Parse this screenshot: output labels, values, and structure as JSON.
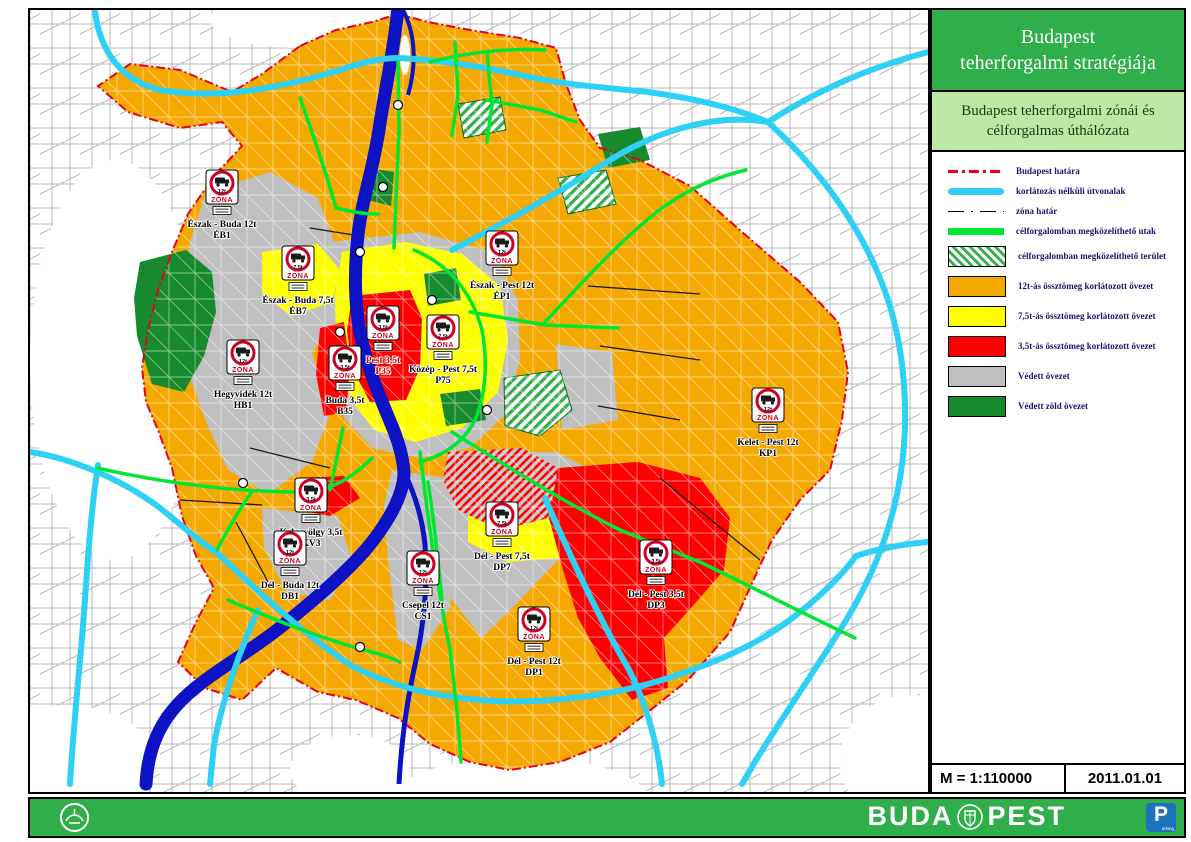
{
  "panel": {
    "title": "Budapest\nteherforgalmi stratégiája",
    "subtitle": "Budapest teherforgalmi zónái és\ncélforgalmas úthálózata",
    "legend": {
      "items": [
        {
          "label": "Budapest határa",
          "swatch": "sw-budapest-border"
        },
        {
          "label": "korlátozás nélküli útvonalak",
          "swatch": "sw-cyan"
        },
        {
          "label": "zóna határ",
          "swatch": "sw-zone-border"
        },
        {
          "label": "célforgalomban megközelíthető utak",
          "swatch": "sw-green-road"
        },
        {
          "label": "célforgalomban megközelíthető terület",
          "swatch": "sw-box-hatch"
        },
        {
          "label": "12t-ás össztömeg korlátozott övezet",
          "swatch": "sw-box-orange"
        },
        {
          "label": "7,5t-ás össztömeg korlátozott övezet",
          "swatch": "sw-box-yellow"
        },
        {
          "label": "3,5t-ás össztömeg korlátozott övezet",
          "swatch": "sw-box-red"
        },
        {
          "label": "Védett övezet",
          "swatch": "sw-box-gray"
        },
        {
          "label": "Védett zöld övezet",
          "swatch": "sw-box-green"
        }
      ]
    },
    "scale_label": "M = 1:110000",
    "date_label": "2011.01.01"
  },
  "footer": {
    "brand_left": "BUDA",
    "brand_right": "PEST",
    "parking_p": "P",
    "parking_sub": "arking"
  },
  "map": {
    "sign_zona": "ZÓNA",
    "colors": {
      "zone_12t": "#F5A800",
      "zone_7_5t": "#FFFF00",
      "zone_3_5t": "#FF0000",
      "protected_zone": "#BFBFBF",
      "protected_green_zone": "#168A2C",
      "accessible_roads": "#00E632",
      "unrestricted_roads": "#2FD0F5",
      "budapest_border": "#E8001C",
      "river": "#0D12C4",
      "header_green": "#2FAE49",
      "subheader_green": "#BCE8A6"
    },
    "zones": [
      {
        "name": "Észak - Buda 12t",
        "code": "ÉB1",
        "weight": "12t",
        "x": 222,
        "y": 192
      },
      {
        "name": "Észak - Buda 7,5t",
        "code": "ÉB7",
        "weight": "7,5t",
        "x": 298,
        "y": 268
      },
      {
        "name": "Hegyvidék 12t",
        "code": "HB1",
        "weight": "12t",
        "x": 243,
        "y": 362
      },
      {
        "name": "Észak - Pest 12t",
        "code": "ÉP1",
        "weight": "12t",
        "x": 502,
        "y": 253
      },
      {
        "name": "Közép - Pest 7,5t",
        "code": "P75",
        "weight": "7,5t",
        "x": 443,
        "y": 337
      },
      {
        "name": "Pest 3,5t",
        "code": "P35",
        "weight": "3,5t",
        "x": 383,
        "y": 328,
        "color": "#c00000"
      },
      {
        "name": "Buda 3,5t",
        "code": "B35",
        "weight": "3,5t",
        "x": 345,
        "y": 368
      },
      {
        "name": "Kelet - Pest 12t",
        "code": "KP1",
        "weight": "12t",
        "x": 768,
        "y": 410
      },
      {
        "name": "Kelenvölgy 3,5t",
        "code": "KV3",
        "weight": "3,5t",
        "x": 311,
        "y": 500
      },
      {
        "name": "Dél - Buda 12t",
        "code": "DB1",
        "weight": "12t",
        "x": 290,
        "y": 553
      },
      {
        "name": "Csepel 12t",
        "code": "CS1",
        "weight": "12t",
        "x": 423,
        "y": 573
      },
      {
        "name": "Dél - Pest 7,5t",
        "code": "DP7",
        "weight": "7,5t",
        "x": 502,
        "y": 524
      },
      {
        "name": "Dél - Pest 12t",
        "code": "DP1",
        "weight": "12t",
        "x": 534,
        "y": 629
      },
      {
        "name": "Dél - Pest 3,5t",
        "code": "DP3",
        "weight": "3,5t",
        "x": 656,
        "y": 562
      }
    ],
    "motorways": [
      {
        "t": "M1",
        "x": 25,
        "y": 452
      },
      {
        "t": "M7",
        "x": 48,
        "y": 582
      },
      {
        "t": "M0",
        "x": 105,
        "y": 576
      },
      {
        "t": "M0",
        "x": 405,
        "y": 690
      },
      {
        "t": "M6",
        "x": 208,
        "y": 646
      },
      {
        "t": "M5",
        "x": 635,
        "y": 688
      },
      {
        "t": "M3",
        "x": 490,
        "y": 215
      },
      {
        "t": "M3",
        "x": 623,
        "y": 87
      },
      {
        "t": "M4",
        "x": 892,
        "y": 561
      }
    ],
    "streets": [
      {
        "t": "Batthyány utca",
        "x": 142,
        "y": 64,
        "r": 0
      },
      {
        "t": "Pünkösdfürdő utca",
        "x": 398,
        "y": 37,
        "r": 0
      },
      {
        "t": "Ipartelep u.",
        "x": 396,
        "y": 54,
        "r": -65
      },
      {
        "t": "Rákóczi utca",
        "x": 373,
        "y": 116,
        "r": -90
      },
      {
        "t": "Bajor utca",
        "x": 376,
        "y": 138,
        "r": 0
      },
      {
        "t": "Óceánárok utca",
        "x": 455,
        "y": 58,
        "r": 0
      },
      {
        "t": "Ipari park utca",
        "x": 506,
        "y": 67,
        "r": 0
      },
      {
        "t": "Íves út",
        "x": 478,
        "y": 44,
        "r": -20
      },
      {
        "t": "Megyeri út",
        "x": 468,
        "y": 86,
        "r": 0
      },
      {
        "t": "Váci út",
        "x": 425,
        "y": 96,
        "r": -90
      },
      {
        "t": "Fóti út",
        "x": 443,
        "y": 104,
        "r": -65
      },
      {
        "t": "Irányi D. u.",
        "x": 446,
        "y": 123,
        "r": -15
      },
      {
        "t": "Duna sor",
        "x": 418,
        "y": 130,
        "r": -80
      },
      {
        "t": "Garam u.",
        "x": 438,
        "y": 142,
        "r": 0
      },
      {
        "t": "Megyeri út",
        "x": 450,
        "y": 133,
        "r": -15
      },
      {
        "t": "Bécsi út",
        "x": 264,
        "y": 106,
        "r": -40
      },
      {
        "t": "Törökvész utca",
        "x": 270,
        "y": 128,
        "r": 0
      },
      {
        "t": "Csillaghegyi utca",
        "x": 264,
        "y": 140,
        "r": 0
      },
      {
        "t": "Áldomás utca",
        "x": 258,
        "y": 151,
        "r": 0
      },
      {
        "t": "Kunigunda utca",
        "x": 253,
        "y": 162,
        "r": 0
      },
      {
        "t": "Szőlőkert utca",
        "x": 255,
        "y": 172,
        "r": 0
      },
      {
        "t": "Huszti utca",
        "x": 251,
        "y": 181,
        "r": 0
      },
      {
        "t": "Szentendrei út",
        "x": 352,
        "y": 194,
        "r": -82
      },
      {
        "t": "Vörösvári út",
        "x": 316,
        "y": 230,
        "r": -10
      },
      {
        "t": "Budaörsi út",
        "x": 258,
        "y": 452,
        "r": -35
      },
      {
        "t": "Repülőtéri út",
        "x": 238,
        "y": 500,
        "r": 0
      },
      {
        "t": "Balatoni út",
        "x": 250,
        "y": 583,
        "r": -55
      },
      {
        "t": "Egér út",
        "x": 284,
        "y": 476,
        "r": 0
      },
      {
        "t": "Ady Endre út",
        "x": 308,
        "y": 512,
        "r": -15
      },
      {
        "t": "Hunyadi J. út",
        "x": 346,
        "y": 580,
        "r": -85
      },
      {
        "t": "Kerepesi út",
        "x": 565,
        "y": 328,
        "r": -5
      },
      {
        "t": "Üllői út",
        "x": 520,
        "y": 468,
        "r": -30
      },
      {
        "t": "Soroksári út",
        "x": 432,
        "y": 500,
        "r": -80
      },
      {
        "t": "Helsinki út",
        "x": 452,
        "y": 576,
        "r": -80
      },
      {
        "t": "Nagykőrösi út",
        "x": 505,
        "y": 598,
        "r": -40
      },
      {
        "t": "Könyves Kálmán körút",
        "x": 430,
        "y": 428,
        "r": -10
      },
      {
        "t": "Veres Péter út",
        "x": 640,
        "y": 289,
        "r": -12
      },
      {
        "t": "Ferihegyi repülőtérre vezető út",
        "x": 724,
        "y": 505,
        "r": -35
      },
      {
        "t": "Jászberényi út",
        "x": 648,
        "y": 347,
        "r": -10
      },
      {
        "t": "Csömöri út",
        "x": 590,
        "y": 252,
        "r": -35
      },
      {
        "t": "Gyömrői út",
        "x": 600,
        "y": 408,
        "r": -10
      }
    ]
  }
}
